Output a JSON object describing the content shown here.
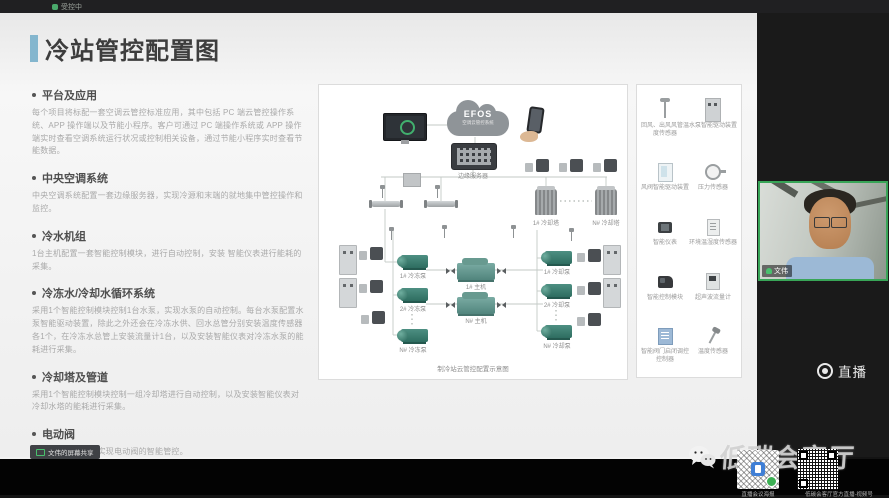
{
  "window": {
    "top_status": "受控中"
  },
  "slide": {
    "title": "冷站管控配置图",
    "sections": [
      {
        "heading": "平台及应用",
        "body": "每个项目将标配一套空调云管控标准应用，其中包括 PC 端云管控操作系统、APP 操作端以及节能小程序。客户可通过 PC 端操作系统或 APP 操作端实时查看空调系统运行状况或控制相关设备，通过节能小程序实时查看节能数据。"
      },
      {
        "heading": "中央空调系统",
        "body": "中央空调系统配置一套边缘服务器，实现冷源和末端的就地集中管控操作和监控。"
      },
      {
        "heading": "冷水机组",
        "body": "1台主机配置一套智能控制模块，进行自动控制，安装 智能仪表进行能耗的采集。"
      },
      {
        "heading": "冷冻水/冷却水循环系统",
        "body": "采用1个智能控制模块控制1台水泵，实现水泵的自动控制。每台水泵配置水泵智能驱动装置，除此之外还会在冷冻水供、回水总管分别安装温度传感器各1个，在冷冻水总管上安装流量计1台，以及安装智能仪表对冷冻水泵的能耗进行采集。"
      },
      {
        "heading": "冷却塔及管道",
        "body": "采用1个智能控制模块控制一组冷却塔进行自动控制，以及安装智能仪表对冷却水塔的能耗进行采集。"
      },
      {
        "heading": "电动阀",
        "body": "配置阀门调控箱，实现电动阀的智能管控。"
      }
    ],
    "diagram": {
      "cloud_logo": "EFOS",
      "cloud_subtitle": "空调云管控系统",
      "edge_server_label": "边缘服务器",
      "tower_labels": [
        "1# 冷却塔",
        "N# 冷却塔"
      ],
      "chiller_labels": [
        "1# 主机",
        "N# 主机"
      ],
      "chilled_pumps": [
        "1# 冷冻泵",
        "2# 冷冻泵",
        "N# 冷冻泵"
      ],
      "cooling_pumps": [
        "1# 冷却泵",
        "2# 冷却泵",
        "N# 冷却泵"
      ],
      "caption": "制冷站云管控配置示意图"
    },
    "legend": {
      "items": [
        {
          "label": "回风、出风风管温度传感器",
          "icon": "duct-temp-sensor-icon"
        },
        {
          "label": "水泵智能驱动装置",
          "icon": "pump-drive-cabinet-icon"
        },
        {
          "label": "风阀智能驱动装置",
          "icon": "damper-drive-icon"
        },
        {
          "label": "压力传感器",
          "icon": "pressure-sensor-icon"
        },
        {
          "label": "智能仪表",
          "icon": "smart-meter-icon"
        },
        {
          "label": "环境温湿度传感器",
          "icon": "env-temp-humidity-sensor-icon"
        },
        {
          "label": "智能控制模块",
          "icon": "control-module-icon"
        },
        {
          "label": "超声波流量计",
          "icon": "ultrasonic-flowmeter-icon"
        },
        {
          "label": "智能阀门启闭调控控制器",
          "icon": "valve-controller-icon"
        },
        {
          "label": "温度传感器",
          "icon": "temp-probe-icon"
        }
      ]
    },
    "share_tab_label": "文伟的屏幕共享"
  },
  "meeting": {
    "participant_name": "文伟",
    "live_label": "直播"
  },
  "overlay": {
    "watermark": "低碳会客厅",
    "wechat_icon": "wechat-icon",
    "qr_left_caption": "直播会议海报",
    "qr_right_caption": "低碳会客厅官方直播-视频号"
  }
}
